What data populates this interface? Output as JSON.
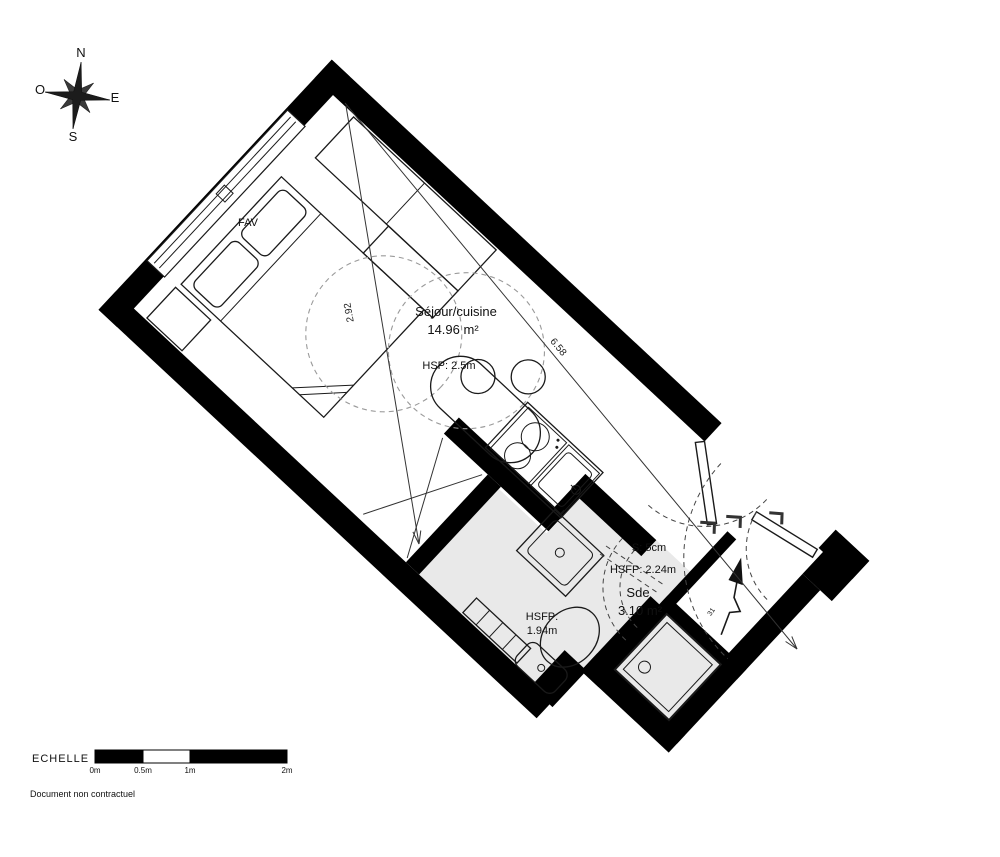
{
  "compass": {
    "n": "N",
    "e": "E",
    "s": "S",
    "o": "O"
  },
  "plan": {
    "window_label": "FAV",
    "living": {
      "name": "Séjour/cuisine",
      "area": "14.96 m²",
      "height": "HSP: 2.5m"
    },
    "bathroom": {
      "name": "Sde",
      "area": "3.10 m²",
      "note_s": "S: 5cm",
      "note_hsfp_high": "HSFP: 2.24m",
      "note_hsfp_low1": "HSFP:",
      "note_hsfp_low2": "1.94m"
    },
    "dimensions": {
      "length": "6.58",
      "width": "2.92"
    },
    "entry_mark": "31"
  },
  "scale": {
    "title": "ECHELLE",
    "ticks": [
      "0m",
      "0.5m",
      "1m",
      "2m"
    ]
  },
  "footer": "Document non contractuel",
  "colors": {
    "wall": "#000000",
    "bath_floor": "#e9e9e9",
    "dashed_guides": "#9a9a9a"
  }
}
